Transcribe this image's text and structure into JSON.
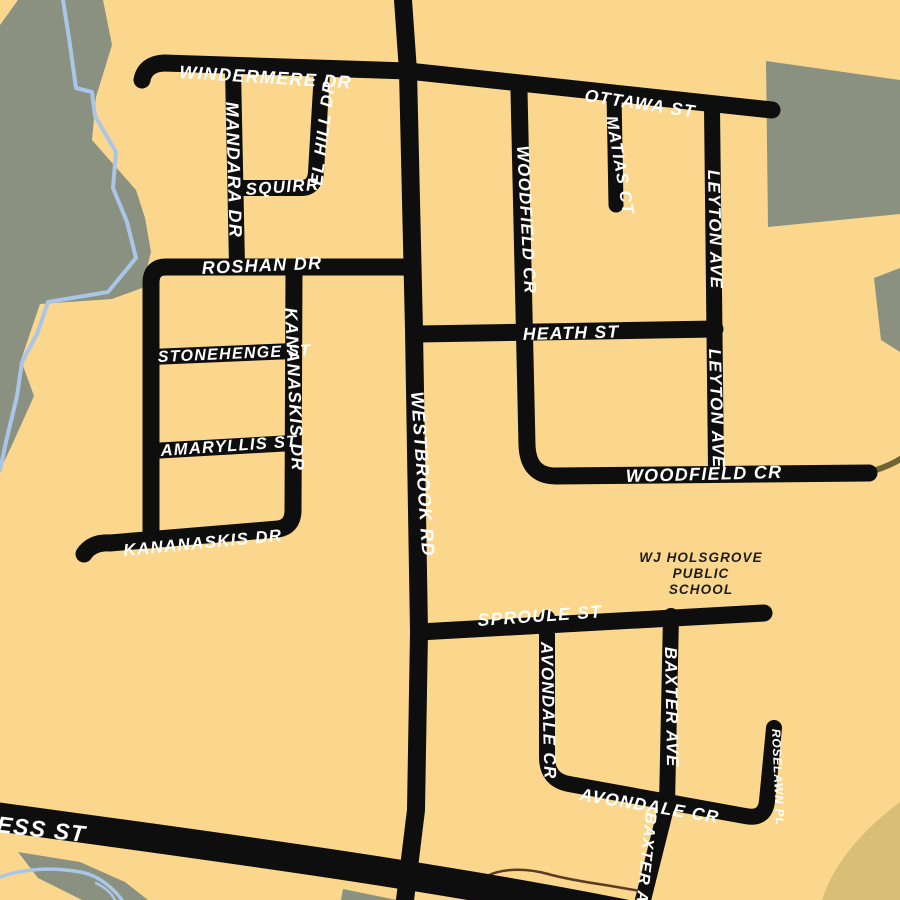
{
  "map": {
    "colors": {
      "background": "#FBD78D",
      "street": "#0E0E0E",
      "label": "#FFFFFF",
      "park": "#8B9180",
      "water": "#A9C6E8",
      "field": "#D9BE77",
      "trail": "#6F6233",
      "stream_outline": "#5C3A23",
      "school_text": "#1C1C1C"
    },
    "labels": {
      "windermere": "WINDERMERE DR",
      "mandara": "MANDARA DR",
      "squirrel_a": "SQUIRR",
      "squirrel_b": "EL HILL DR",
      "ottawa": "OTTAWA ST",
      "matias": "MATIAS CT",
      "woodfield_v": "WOODFIELD CR",
      "leyton_1": "LEYTON AVE",
      "roshan": "ROSHAN DR",
      "heath": "HEATH ST",
      "kananaskis_v": "KANANASKIS DR",
      "stonehenge": "STONEHENGE ST",
      "amaryllis": "AMARYLLIS ST",
      "westbrook": "WESTBROOK RD",
      "leyton_2": "LEYTON AVE",
      "woodfield_h": "WOODFIELD CR",
      "kananaskis_h": "KANANASKIS DR",
      "inverness": "ESS ST",
      "sproule": "SPROULE ST",
      "avondale_v": "AVONDALE CR",
      "baxter_1": "BAXTER AVE",
      "avondale_h": "AVONDALE CR",
      "roselawn": "ROSELAWN PL",
      "baxter_2": "BAXTER AVE",
      "school": {
        "line1": "WJ HOLSGROVE",
        "line2": "PUBLIC",
        "line3": "SCHOOL"
      }
    }
  }
}
